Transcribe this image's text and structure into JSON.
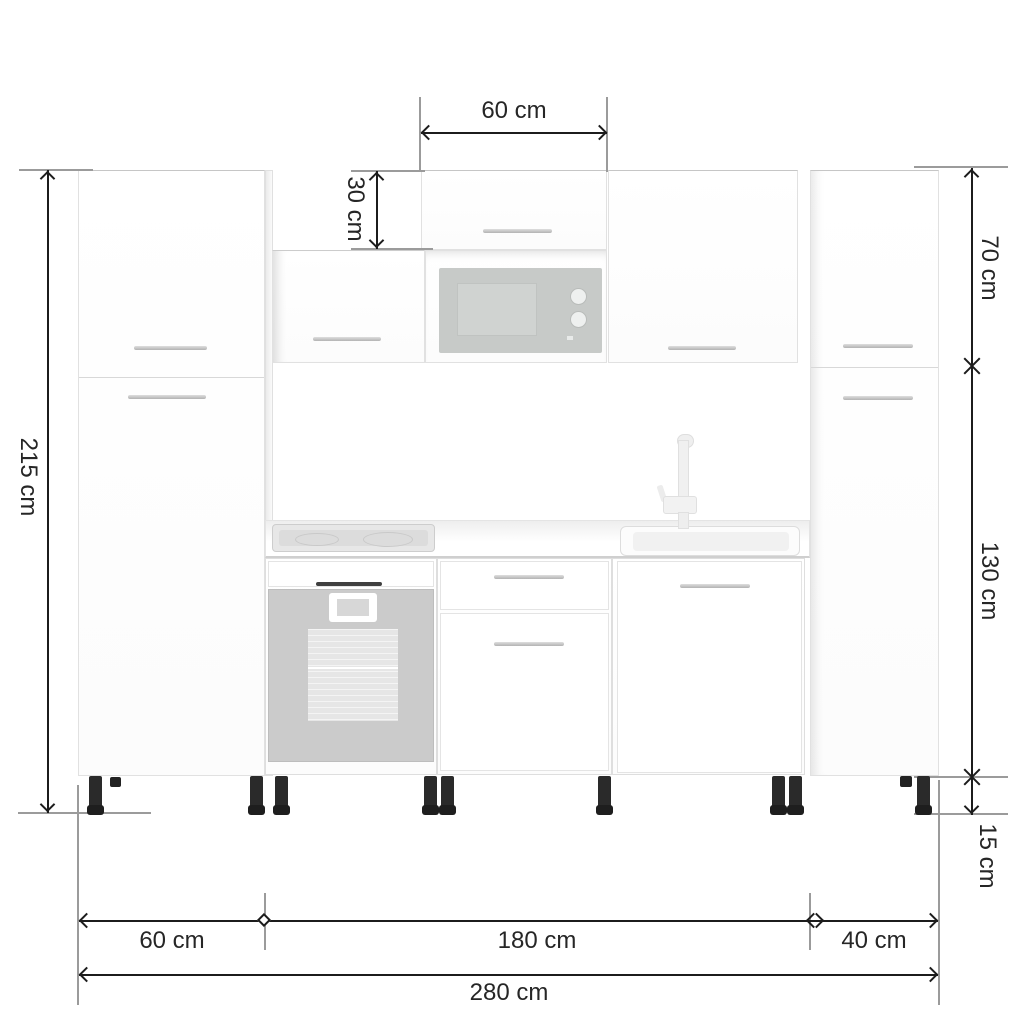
{
  "dimension_labels": {
    "upper_cabinet_width": "60 cm",
    "upper_cabinet_height": "30 cm",
    "wall_section_height": "70 cm",
    "total_height": "215 cm",
    "base_section_height": "130 cm",
    "leg_height": "15 cm",
    "left_cabinet_width": "60 cm",
    "center_section_width": "180 cm",
    "right_cabinet_width": "40 cm",
    "total_width": "280 cm"
  }
}
